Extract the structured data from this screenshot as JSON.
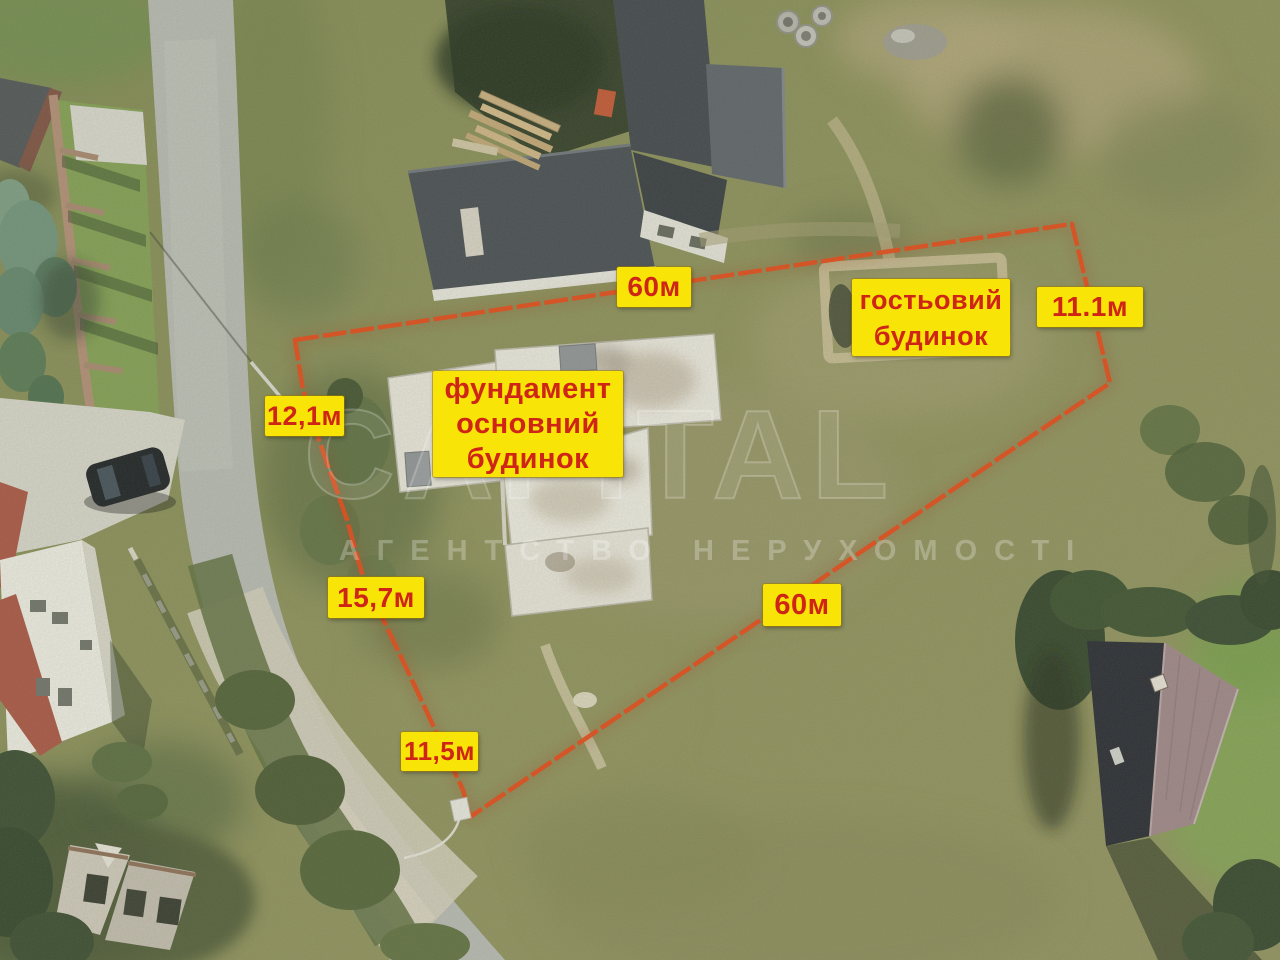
{
  "annotations": {
    "top_side": "60м",
    "guest_house": "гостьовий\nбудинок",
    "right_side": "11.1м",
    "left_upper": "12,1м",
    "main_foundation": "фундамент\nосновний\nбудинок",
    "left_middle": "15,7м",
    "bottom_side": "60м",
    "left_lower": "11,5м"
  },
  "watermark": {
    "brand": "CAPITAL",
    "tagline": "АГЕНТСТВО НЕРУХОМОСТІ"
  },
  "colors": {
    "boundary": "#e8400e",
    "label_bg": "#f8e406",
    "label_text": "#cf2517"
  }
}
